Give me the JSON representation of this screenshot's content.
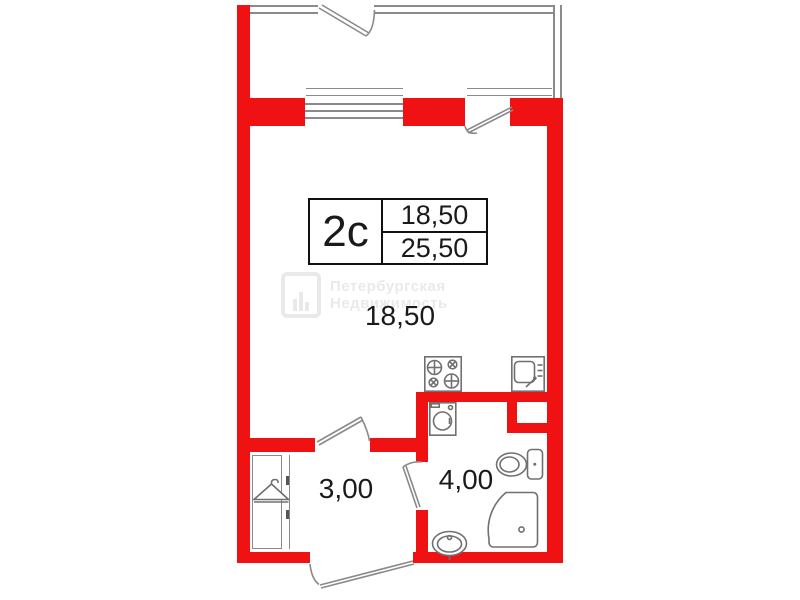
{
  "plan": {
    "info_box": {
      "unit_code": "2c",
      "area_top": "18,50",
      "area_bottom": "25,50"
    },
    "room_labels": {
      "main_room": "18,50",
      "hallway": "3,00",
      "bathroom": "4,00"
    },
    "watermark": {
      "line1": "Петербургская",
      "line2": "Недвижимость"
    },
    "icons": [
      {
        "name": "stove-icon"
      },
      {
        "name": "kitchen-sink-icon"
      },
      {
        "name": "washing-machine-icon"
      },
      {
        "name": "toilet-icon"
      },
      {
        "name": "shower-icon"
      },
      {
        "name": "bathroom-sink-icon"
      },
      {
        "name": "coat-hanger-icon"
      }
    ],
    "colors": {
      "wall_red": "#F01212",
      "thin_wall_gray": "#8A8A8A",
      "icon_gray": "#707070",
      "text": "#1A1A1A"
    }
  }
}
